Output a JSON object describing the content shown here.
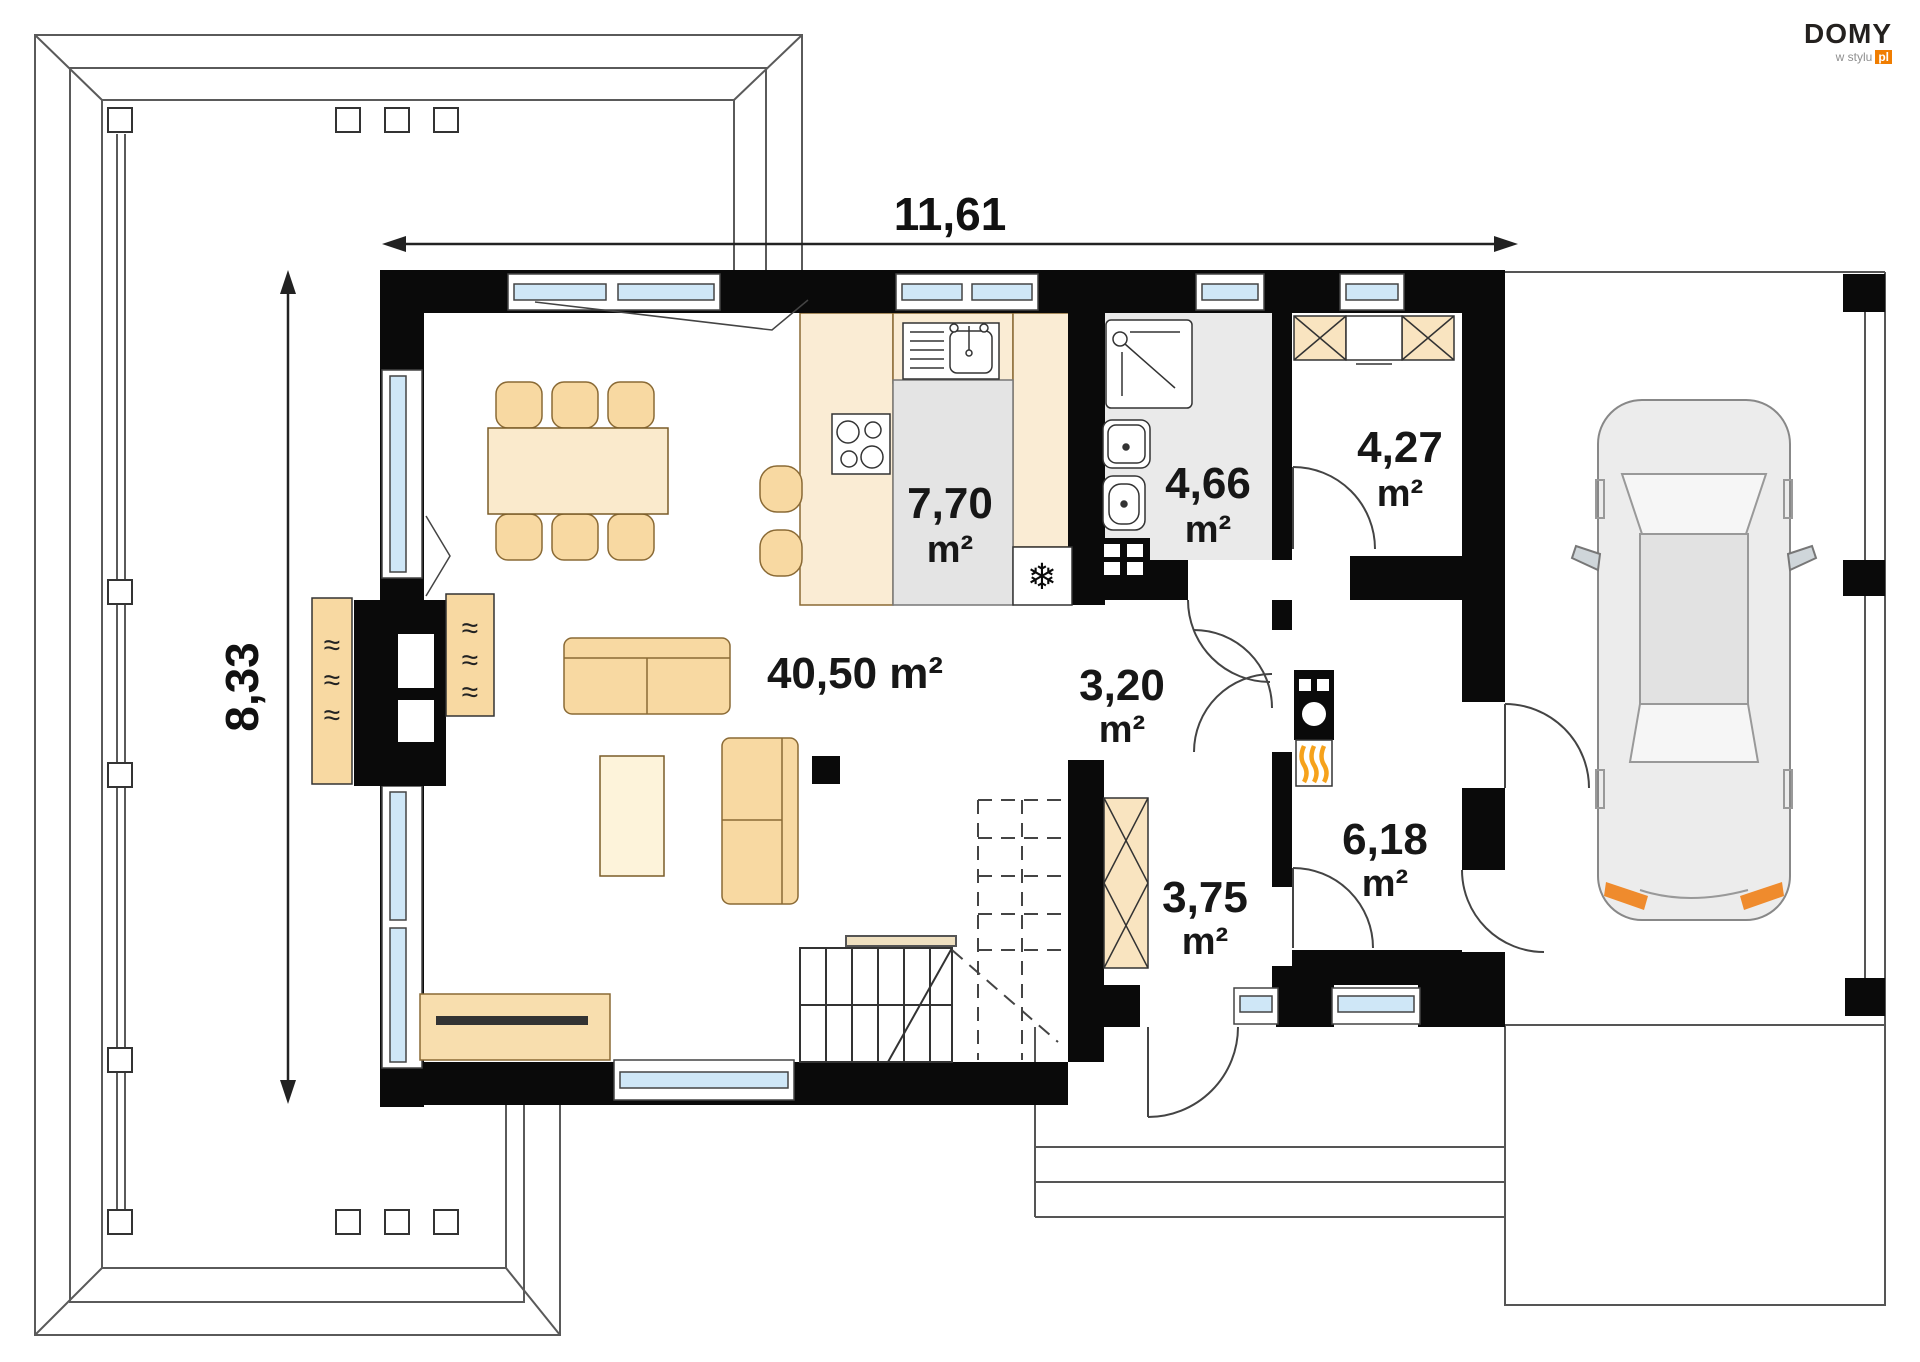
{
  "colors": {
    "wall": "#0a0a0a",
    "window_glass": "#cfe7f7",
    "furniture": "#f8d9a2",
    "furniture_light": "#faeacc",
    "counter": "#faecd4",
    "island_gray": "#e4e4e4",
    "bath_floor": "#eaeaea",
    "logo_orange": "#f07d00",
    "flame_orange": "#f6a21c",
    "car_gray": "#ececec",
    "outline": "#555555"
  },
  "logo": {
    "brand": "DOMY",
    "tagline": "w stylu",
    "tld": "pl"
  },
  "dimensions": {
    "width_total": "11,61",
    "depth_total": "8,33"
  },
  "rooms": {
    "living_dining": {
      "label": "40,50 m²",
      "value": "40,50",
      "unit": "m²"
    },
    "kitchen": {
      "value": "7,70",
      "unit": "m²"
    },
    "bathroom": {
      "value": "4,66",
      "unit": "m²"
    },
    "wardrobe": {
      "value": "4,27",
      "unit": "m²"
    },
    "hall": {
      "value": "3,20",
      "unit": "m²"
    },
    "entry_hall": {
      "value": "3,75",
      "unit": "m²"
    },
    "utility_room": {
      "value": "6,18",
      "unit": "m²"
    }
  },
  "icons": {
    "radiator_wave": "≈",
    "snowflake": "❄"
  }
}
